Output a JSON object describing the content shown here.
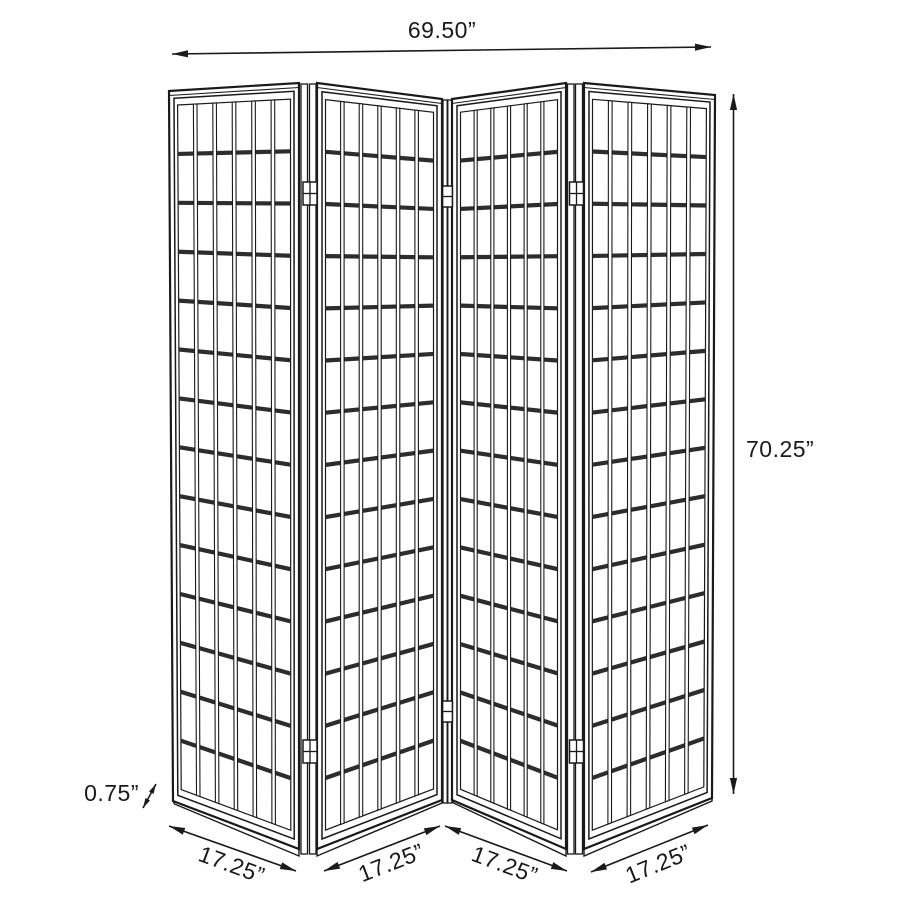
{
  "diagram": {
    "type": "product-dimension-diagram",
    "subject": "four-panel folding screen room divider",
    "panel_count": 4,
    "panel_grid": {
      "columns": 6,
      "rows": 14
    },
    "labels": {
      "total_width": "69.50”",
      "panel_height": "70.25”",
      "frame_thickness": "0.75”",
      "panel_width_1": "17.25”",
      "panel_width_2": "17.25”",
      "panel_width_3": "17.25”",
      "panel_width_4": "17.25”"
    },
    "colors": {
      "line": "#1a1a1a",
      "lattice_band": "#2d2d2d",
      "background": "#ffffff"
    }
  }
}
